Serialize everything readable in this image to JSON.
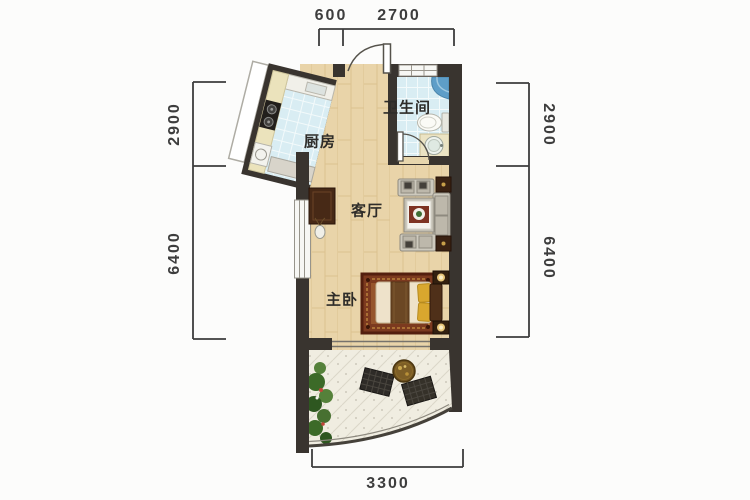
{
  "floor_plan": {
    "rooms": {
      "kitchen": {
        "label": "厨房"
      },
      "bathroom": {
        "label": "卫生间"
      },
      "living_room": {
        "label": "客厅"
      },
      "master_bedroom": {
        "label": "主卧"
      }
    },
    "dimensions_mm": {
      "top": [
        "600",
        "2700"
      ],
      "left": [
        "2900",
        "6400"
      ],
      "right": [
        "2900",
        "6400"
      ],
      "bottom": [
        "3300"
      ]
    },
    "colors": {
      "wall": "#39342f",
      "wood_floor": "#e9d4a9",
      "tile_floor": "#d9edf3",
      "balcony_floor": "#f0ede1",
      "dimension": "#3d3d3d"
    }
  }
}
